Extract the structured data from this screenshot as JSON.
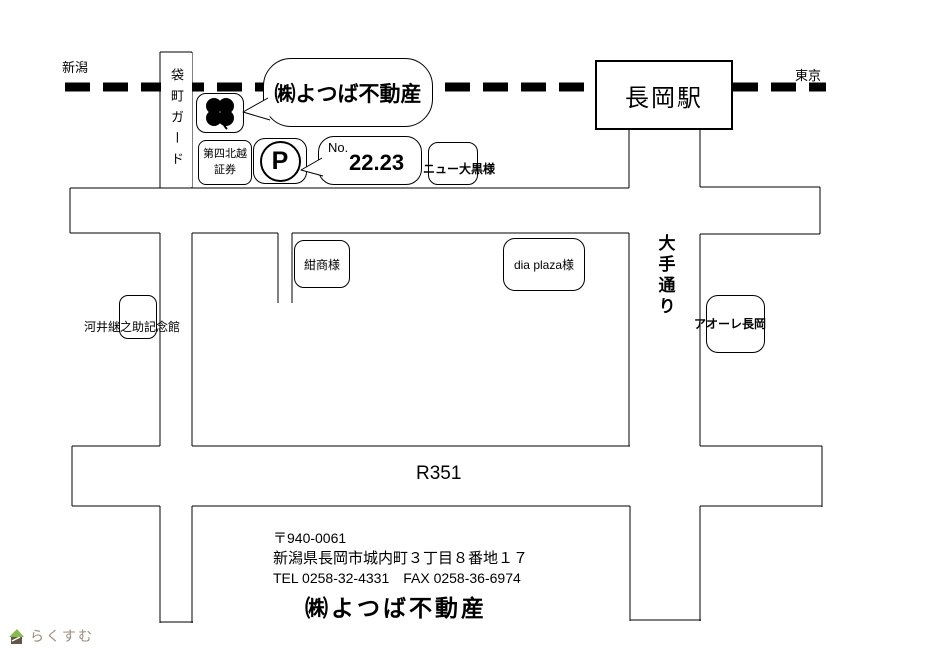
{
  "map": {
    "rail": {
      "left_label": "新潟",
      "right_label": "東京",
      "guard_label": "袋町ガード",
      "station_label": "長岡駅"
    },
    "office_bubble": {
      "label": "㈱よつば不動産"
    },
    "landmarks": {
      "securities_line1": "第四北越",
      "securities_line2": "証券",
      "parking_letter": "P",
      "parking_no_label": "No.",
      "parking_no_value": "22.23",
      "new_daikoku": "ニュー大黒様",
      "konsho": "紺商様",
      "dia_plaza": "dia plaza様",
      "aore": "アオーレ長岡",
      "kawai_memorial": "河井継之助記念館"
    },
    "streets": {
      "ote_dori": "大手通り",
      "route": "R351"
    }
  },
  "footer": {
    "postal": "〒940-0061",
    "address": "新潟県長岡市城内町３丁目８番地１７",
    "tel_fax": "TEL 0258-32-4331　FAX 0258-36-6974",
    "company": "㈱よつば不動産"
  },
  "watermark": {
    "text": "らくすむ"
  },
  "colors": {
    "ink": "#000000",
    "watermark_text": "#9c8d7c",
    "watermark_leaf": "#8aba4e",
    "watermark_body": "#60564c"
  }
}
